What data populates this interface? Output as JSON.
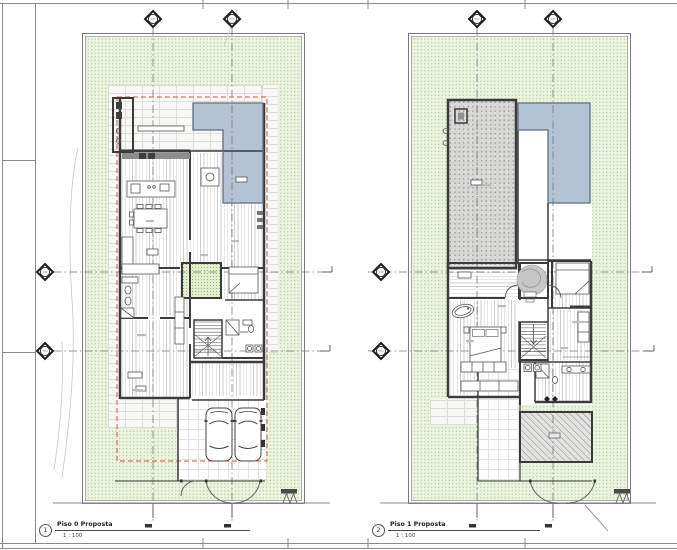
{
  "sheet": {
    "type": "architectural plan sheet",
    "views": [
      {
        "number": "1",
        "title": "Piso 0 Proposta",
        "scale": "1 : 100"
      },
      {
        "number": "2",
        "title": "Piso 1 Proposta",
        "scale": "1 : 100"
      }
    ],
    "colors": {
      "site_green": "#ecf2e0",
      "pool_blue": "#b4c2d5",
      "terrace_grey": "#d6d6d4",
      "wall_dark": "#3b3b3b",
      "property_line_red": "#cd5a40",
      "grid_line_grey": "#777777"
    },
    "markers": {
      "top_grid_bubbles": 4,
      "side_grid_bubbles": 4,
      "bubble_style": "diamond-with-circle"
    }
  }
}
